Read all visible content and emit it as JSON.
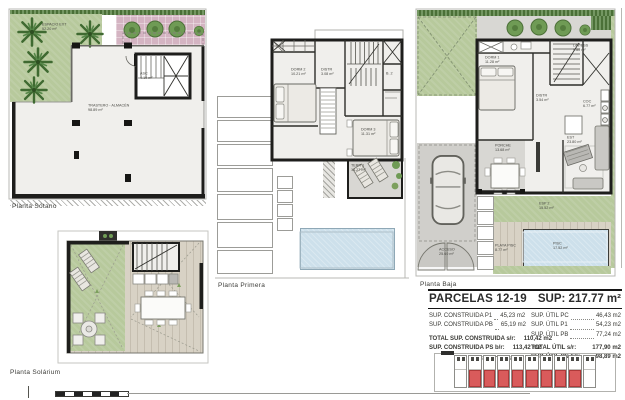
{
  "plans": {
    "sotano": {
      "label": "Planta Sótano",
      "espacio_ext": "ESPACIO EXT",
      "espacio_ext_area": "52.20 m²",
      "trastero": "TRASTERO - ALMACÉN",
      "trastero_area": "98.89 m²",
      "asc": "ASC",
      "asc_area": "4.10 m²"
    },
    "primera": {
      "label": "Planta Primera",
      "dorm2": "DORM 2",
      "dorm2_area": "10.21 m²",
      "distr": "DISTR",
      "distr_area": "3.08 m²",
      "bath": "B. 2",
      "dorm3": "DORM 3",
      "dorm3_area": "11.31 m²",
      "terr": "TERR 1",
      "terr_area": "14.27 m²"
    },
    "baja": {
      "label": "Planta Baja",
      "lav": "LAV/ESS",
      "lav_area": "9.80 m²",
      "dorm1": "DORM 1",
      "dorm1_area": "11.28 m²",
      "distr": "DISTR",
      "distr_area": "3.54 m²",
      "coc": "COC",
      "coc_area": "6.77 m²",
      "est": "EST",
      "est_area": "23.80 m²",
      "porche": "PORCHE",
      "porche_area": "13.68 m²",
      "acceso": "ACCESO",
      "acceso_area": "25.60 m²",
      "esp2": "ESP 2",
      "esp2_area": "15.52 m²",
      "playa": "PLAYA PISC",
      "playa_area": "8.77 m²",
      "pisc": "PISC",
      "pisc_area": "17.52 m²"
    },
    "solarium": {
      "label": "Planta Solárium"
    }
  },
  "summary": {
    "title": "PARCELAS 12-19",
    "sup_text": "SUP: 217.77 m²",
    "left_rows": [
      {
        "label": "SUP. CONSTRUIDA P1",
        "value": "45,23 m2"
      },
      {
        "label": "SUP. CONSTRUIDA PB",
        "value": "65,19 m2"
      }
    ],
    "left_totals": [
      {
        "label": "TOTAL SUP. CONSTRUIDA s/r:",
        "value": "110,42 m2"
      },
      {
        "label": "SUP. CONSTRUIDA PS b/r:",
        "value": "113,42 m2"
      }
    ],
    "right_rows": [
      {
        "label": "SUP. ÚTIL PC",
        "value": "46,43 m2"
      },
      {
        "label": "SUP. ÚTIL P1",
        "value": "54,23 m2"
      },
      {
        "label": "SUP. ÚTIL PB",
        "value": "77,24 m2"
      }
    ],
    "right_totals": [
      {
        "label": "TOTAL ÚTIL s/r:",
        "value": "177,90 m2"
      },
      {
        "label": "SUP. ÚTIL PS b/r:",
        "value": "98,89 m2"
      }
    ],
    "phase_left": "2ª fase",
    "phase_right": "1ª fase"
  },
  "key_plan": {
    "units_total": 10,
    "highlight_start": 1,
    "highlight_count": 8,
    "highlight_color": "#d95b5b"
  }
}
